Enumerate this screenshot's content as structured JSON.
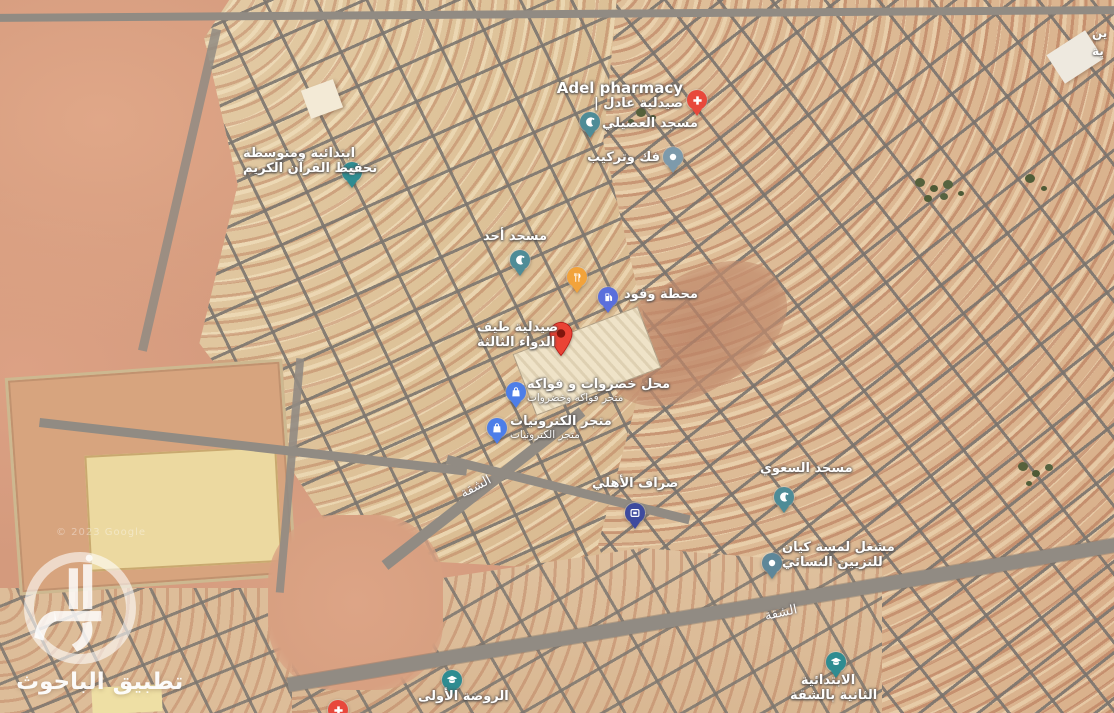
{
  "app": {
    "watermark_app_name": "تطبيق الباحوث",
    "copyright": "© 2023 Google"
  },
  "map": {
    "pin_colors": {
      "pharmacy": "#E8483B",
      "destination": "#EA4335",
      "destination_dot": "#7F150D",
      "mosque": "#4E8C97",
      "school": "#2F8C91",
      "generic": "#7D9AAB",
      "salon": "#5E8799",
      "gas": "#5A6FDC",
      "shopping": "#4D7EE8",
      "atm": "#3E4B9E",
      "restaurant": "#F2A33B"
    },
    "pins": [
      {
        "id": "adel-pharmacy",
        "type": "pharmacy",
        "icon": "pharmacy-cross-icon",
        "x": 697,
        "y": 116,
        "label": {
          "left": 548,
          "top": 80,
          "width": 135,
          "align": "right",
          "lines": [
            {
              "t": "Adel pharmacy",
              "cls": "latin"
            },
            {
              "t": "| صيدلية عادل"
            }
          ]
        }
      },
      {
        "id": "usaili-mosque",
        "type": "mosque",
        "icon": "crescent-icon",
        "x": 590,
        "y": 138,
        "label": {
          "left": 602,
          "top": 117,
          "width": 95,
          "align": "left",
          "lines": [
            {
              "t": "مسجد العصيلي"
            }
          ]
        }
      },
      {
        "id": "fakk-tarkib",
        "type": "generic",
        "icon": "dot-icon",
        "x": 673,
        "y": 173,
        "label": {
          "left": 578,
          "top": 151,
          "width": 82,
          "align": "right",
          "lines": [
            {
              "t": "فك وتركيب"
            }
          ]
        }
      },
      {
        "id": "quran-memorization-school",
        "type": "school",
        "icon": "grad-cap-icon",
        "x": 352,
        "y": 188,
        "label": {
          "left": 243,
          "top": 147,
          "width": 100,
          "align": "right",
          "lines": [
            {
              "t": "ابتدائية ومتوسطة"
            },
            {
              "t": "تحفيظ القرآن الكريم"
            }
          ]
        }
      },
      {
        "id": "ahad-mosque",
        "type": "mosque",
        "icon": "crescent-icon",
        "x": 520,
        "y": 276,
        "label": {
          "left": 483,
          "top": 230,
          "width": 62,
          "align": "center",
          "lines": [
            {
              "t": "مسجد أحد"
            }
          ]
        }
      },
      {
        "id": "restaurant",
        "type": "restaurant",
        "icon": "fork-knife-icon",
        "x": 577,
        "y": 293,
        "label": null
      },
      {
        "id": "gas-station",
        "type": "gas",
        "icon": "gas-pump-icon",
        "x": 608,
        "y": 313,
        "label": {
          "left": 624,
          "top": 288,
          "width": 70,
          "align": "left",
          "lines": [
            {
              "t": "محطة وقود"
            }
          ]
        }
      },
      {
        "id": "taif-aldawa-pharmacy-destination",
        "type": "destination",
        "icon": "destination-marker-icon",
        "x": 561,
        "y": 361,
        "label": {
          "left": 477,
          "top": 321,
          "width": 70,
          "align": "center",
          "lines": [
            {
              "t": "صيدلية طيف"
            },
            {
              "t": "الدواء الثالثة"
            }
          ]
        }
      },
      {
        "id": "vegetables-fruits-shop",
        "type": "shopping",
        "icon": "shopping-bag-icon",
        "x": 516,
        "y": 408,
        "label": {
          "left": 527,
          "top": 378,
          "width": 125,
          "align": "left",
          "lines": [
            {
              "t": "محل خضروات و فواكه"
            },
            {
              "t": "متجر فواكه وخضروات",
              "cls": "sub"
            }
          ]
        }
      },
      {
        "id": "electronics-store",
        "type": "shopping",
        "icon": "shopping-bag-icon",
        "x": 497,
        "y": 444,
        "label": {
          "left": 510,
          "top": 415,
          "width": 110,
          "align": "left",
          "lines": [
            {
              "t": "متجر الكترونيات"
            },
            {
              "t": "متجر الكترونيات",
              "cls": "sub"
            }
          ]
        }
      },
      {
        "id": "ahli-atm",
        "type": "atm",
        "icon": "bank-icon",
        "x": 635,
        "y": 529,
        "label": {
          "left": 592,
          "top": 477,
          "width": 75,
          "align": "center",
          "lines": [
            {
              "t": "صراف الأهلي"
            }
          ]
        }
      },
      {
        "id": "saawi-mosque",
        "type": "mosque",
        "icon": "crescent-icon",
        "x": 784,
        "y": 513,
        "label": {
          "left": 760,
          "top": 462,
          "width": 76,
          "align": "center",
          "lines": [
            {
              "t": "مسجد السعوي"
            }
          ]
        }
      },
      {
        "id": "lamsat-kayan-salon",
        "type": "salon",
        "icon": "dot-icon",
        "x": 772,
        "y": 579,
        "label": {
          "left": 782,
          "top": 541,
          "width": 80,
          "align": "center",
          "lines": [
            {
              "t": "مشغل لمسة كيان"
            },
            {
              "t": "للتزيين النسائي"
            }
          ]
        }
      },
      {
        "id": "second-elementary-school",
        "type": "school",
        "icon": "grad-cap-icon",
        "x": 836,
        "y": 678,
        "label": {
          "left": 790,
          "top": 674,
          "width": 76,
          "align": "center",
          "lines": [
            {
              "t": "الابتدائية"
            },
            {
              "t": "الثانية بالشقة"
            }
          ]
        }
      },
      {
        "id": "first-kindergarten",
        "type": "school",
        "icon": "grad-cap-icon",
        "x": 452,
        "y": 696,
        "label": {
          "left": 418,
          "top": 690,
          "width": 68,
          "align": "center",
          "lines": [
            {
              "t": "الروضة الأولى"
            }
          ]
        }
      },
      {
        "id": "clipped-red-pin",
        "type": "pharmacy",
        "icon": "pharmacy-cross-icon",
        "x": 338,
        "y": 726,
        "label": null
      }
    ],
    "street_labels": [
      {
        "text": "الشقة",
        "x": 476,
        "y": 487,
        "rotate": -28
      },
      {
        "text": "الشقة",
        "x": 781,
        "y": 613,
        "rotate": -12
      }
    ],
    "edge_label": {
      "lines": [
        "ين",
        "ية"
      ]
    }
  }
}
